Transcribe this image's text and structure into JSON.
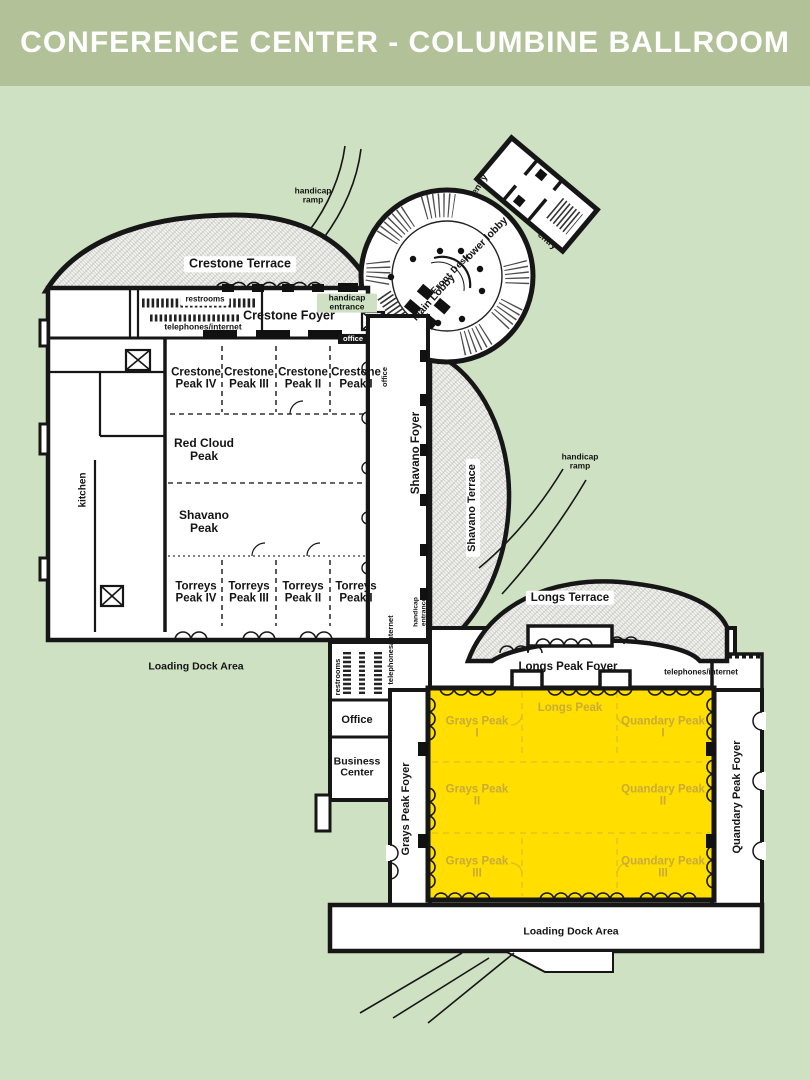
{
  "header": {
    "title": "CONFERENCE CENTER - COLUMBINE BALLROOM"
  },
  "colors": {
    "page_background": "#cfe1c3",
    "header_background": "#b2c197",
    "title_text": "#ffffff",
    "wall": "#161616",
    "terrace_hatch_line": "#c7c7c3",
    "ballroom_highlight": "#ffde00",
    "ballroom_label_text": "#c9ab38"
  },
  "labels": {
    "crestone_terrace": "Crestone Terrace",
    "handicap_ramp_nw": "handicap ramp",
    "restrooms_nw": "restrooms",
    "telephones_nw": "telephones/internet",
    "crestone_foyer": "Crestone Foyer",
    "handicap_entrance_n": "handicap entrance",
    "office_n": "office",
    "office_n_vert": "office",
    "crestone_peak_iv": "Crestone Peak IV",
    "crestone_peak_iii": "Crestone Peak III",
    "crestone_peak_ii": "Crestone Peak II",
    "crestone_peak_i": "Crestone Peak I",
    "red_cloud_peak": "Red Cloud Peak",
    "shavano_peak": "Shavano Peak",
    "torreys_peak_iv": "Torreys Peak IV",
    "torreys_peak_iii": "Torreys Peak III",
    "torreys_peak_ii": "Torreys Peak II",
    "torreys_peak_i": "Torreys Peak I",
    "kitchen": "kitchen",
    "loading_dock_w": "Loading Dock Area",
    "shavano_foyer": "Shavano Foyer",
    "shavano_terrace": "Shavano Terrace",
    "lower_lobby": "lower lobby",
    "front_desk": "Front Desk",
    "main_lobby": "Main Lobby",
    "entry_n": "entry",
    "entry_e": "entry",
    "handicap_ramp_e": "handicap ramp",
    "longs_terrace": "Longs Terrace",
    "longs_peak_foyer": "Longs Peak Foyer",
    "telephones_e": "telephones/internet",
    "handicap_entrance_m": "handicap entrance",
    "telephones_s": "telephones/internet",
    "restrooms_s": "restrooms",
    "office_s": "Office",
    "business_center": "Business Center",
    "grays_peak_foyer": "Grays Peak Foyer",
    "quandary_peak_foyer": "Quandary Peak Foyer",
    "longs_peak": "Longs Peak",
    "grays_peak_i": "Grays Peak I",
    "grays_peak_ii": "Grays Peak II",
    "grays_peak_iii": "Grays Peak III",
    "quandary_peak_i": "Quandary Peak I",
    "quandary_peak_ii": "Quandary Peak II",
    "quandary_peak_iii": "Quandary Peak III",
    "loading_dock_s": "Loading Dock Area"
  }
}
